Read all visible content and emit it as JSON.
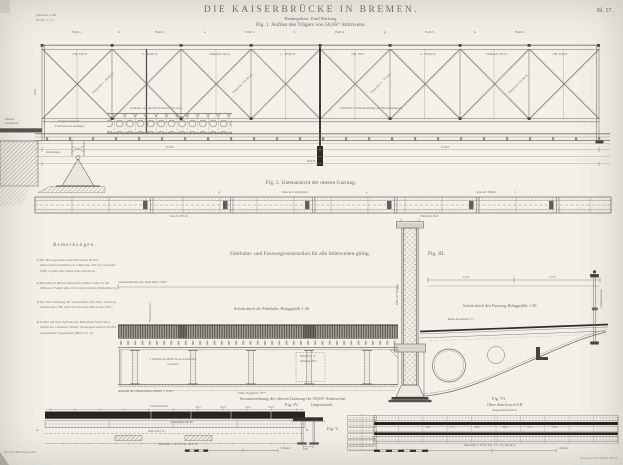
{
  "header": {
    "sheet": "Bl. 57.",
    "title": "DIE KAISERBRÜCKE IN BREMEN.",
    "subtitle": "Bauinspektor: Emil Bücking.",
    "fig1": "Fig. 1. Aufriss des Trägers von 50,65ᵐ Stützweite.",
    "corner1": "Maasstab 1:100",
    "corner2": "für Fig. 1 u. 2."
  },
  "truss": {
    "panels": [
      "Feld 1.",
      "d.",
      "Feld 2.",
      "e.",
      "Feld 3.",
      "f.",
      "Feld 4.",
      "g.",
      "Feld 5.",
      "h.",
      "Feld 6."
    ],
    "member_labels": [
      "2 Bl. 250.10.",
      "4 ⌐ 90.90.10.",
      "Stehblech 250.12.",
      "2 ⌐ 80.80.10.",
      "2 Bl. 250.7.",
      "4 ⌐ 90.90.10.",
      "Stehblech 250.12.",
      "2 Bl. 250.10."
    ],
    "diag_labels": [
      "Diagonale 2 ⌐ 80.80.10.",
      "Diagonale 2 Fl. 90.13.",
      "Diagonale 2 ⌐ 70.70.9.",
      "Diagonale 2 Fl. 80.11."
    ],
    "railing_label": "Geländer aus durchbrochenem Zierwerk.",
    "deck_label_right": "Fahrbahn mit Bohlenbelag und Pferdebahngleis.",
    "cut1": "Schnitt durch die",
    "cut2": "Fahrbahn am Auflager.",
    "street1": "Pflaster.",
    "street2": "Granitbord.",
    "bearing": "Stelzenlager.",
    "height": "4,50ᵐ",
    "dim_left": "25,325",
    "dim_right": "25,325",
    "dim_total": "50,650"
  },
  "fig2": {
    "caption": "Fig. 2. Untenansicht der oberen Gurtung.",
    "letters": [
      "c.",
      "d.",
      "e.",
      "f."
    ],
    "top1": "Stoss der Gurtplatten.",
    "top2": "Stoss der Winkel.",
    "bot1": "Lasche 250.10.",
    "bot2": "Flachstab 60.8."
  },
  "notes": {
    "heading": "Bemerkungen.",
    "items": [
      {
        "num": "1)",
        "text": "Die durchgehends unterstrichenen Brutto-Dimensionen bestehen in 4 Blechen 250.10; ungerade Ziffern geben den Netto-Querschnitt an."
      },
      {
        "num": "2)",
        "text": "Sämmtliche Bleche desselben Feldes haben in der Mitte des Feldes den vollen Querschnitt (Winkeleisen)."
      },
      {
        "num": "3)",
        "text": "Die Durchbildung der Gurtplatten: die obere Gurtung besteht aus 2 Bl. 250.10 und einem Blech von 250.7."
      },
      {
        "num": "4)",
        "text": "Felder mit dem Zeichen der Mittellinie bezeichnen Stösse der einzelnen Theile; herausgeschobene Profile sind punktirt angegeben (Blech Nr. 9)."
      }
    ]
  },
  "fig3": {
    "caption": "Fahrbahn- und Fusswegconstruction für alle Stützweiten gültig.",
    "label": "Fig. III.",
    "width_dim": "Gesammtbreite der Fahrbahn 5,00ᵐ.",
    "road_section": "Schnitt durch die Fahrbahn, Belaggefälle 1:40.",
    "foot_section": "Schnitt durch den Fussweg, Belaggefälle 1:50.",
    "plank": "Bohlenbelag 8ᶜᵐ.",
    "foot_plank": "Belag aus Bohlen 5ᶜᵐ.",
    "girder_note": "2 Winkeleisen 80.80.10 als Aussteifung vernietet.",
    "rivet_note1": "Niete 20ᵐᵐ ∅",
    "rivet_note2": "Theilung 100ᵐᵐ",
    "spacing": "Abstand der Hauptträger-Mitten = 6,50ᵐ.",
    "plate": "Volle Tiefplatte 10ᵐᵐ.",
    "mid": "Mitte der Brücke.",
    "dim1": "1,575",
    "dim2": "1,575",
    "rail": "Geländerpfosten."
  },
  "stoss": {
    "caption": "Stossanordnung der oberen Gurtung für 50,65ᵐ Stützweite."
  },
  "fig4": {
    "label": "Fig. IV.",
    "sub": "Längenansicht.",
    "view": "Untenansicht.",
    "ticks": [
      "23,5",
      "23,5",
      "23,5",
      "23,5"
    ],
    "band": "2 Lamellen 250.10.",
    "center": "Niete 23ᵐᵐ ∅.",
    "a": "A.",
    "b": "B.",
    "scale": "Maasstab 1:10 für Fig. III u. IV.",
    "meter": "1 Meter."
  },
  "fig5": {
    "label": "Fig. V.",
    "dim": "0,30"
  },
  "fig6": {
    "label": "Fig. VI.",
    "sub": "Obere Ansicht nach A-B.",
    "note": "Diagonallasche 60.10.",
    "ticks": [
      "26,5",
      "27,5",
      "28,5",
      "28,5",
      "27,5",
      "26,5"
    ],
    "scale": "Maasstab 1:10 für Fig. V u. VI, Detail A.",
    "meter": "1 Meter."
  },
  "imprint": {
    "left": "Deutsche Bauzeitung 1876.",
    "right": "Verlag von Carl Beelitz, Berlin."
  },
  "colors": {
    "paper": "#f2f0e9",
    "ink": "#6b6963",
    "ink_dark": "#33322c"
  }
}
